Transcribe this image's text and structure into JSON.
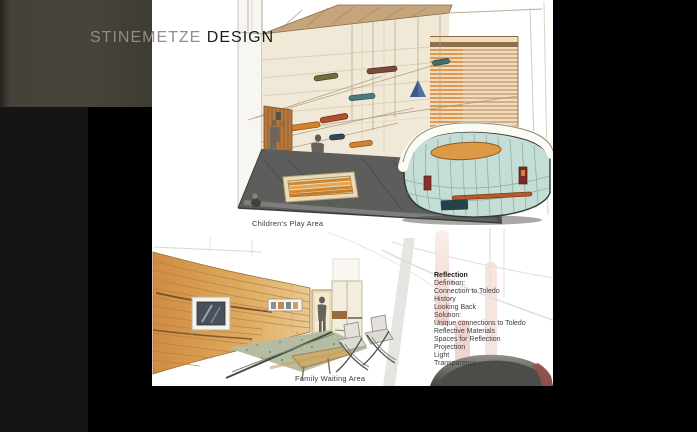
{
  "brand": {
    "muted": "STINEMETZE",
    "strong": "DESIGN"
  },
  "slide": {
    "captions": {
      "children": "Children's Play Area",
      "family": "Family Waiting Area"
    },
    "list": {
      "heading": "Reflection",
      "items": [
        "Definition:",
        "Connection to Toledo",
        "History",
        "Looking Back",
        "Solution:",
        "Unique connections to Toledo",
        "Reflective Materials",
        "Spaces for Reflection",
        "Projection",
        "Light",
        "Transparency"
      ]
    }
  },
  "colors": {
    "letterbox": "#000000",
    "olive_panel": "#46423a",
    "dark_strip": "#151514",
    "slide_bg": "#ffffff",
    "title_muted": "#8f8d86",
    "title_strong": "#1d1d1d",
    "ceiling_tan": "#c6a57b",
    "wall_cream": "#f0e9d7",
    "wood_slat_orange": "#d4813a",
    "floor_charcoal": "#5d5d5b",
    "rug_orange": "#d0862f",
    "desk_teal": "#c4ded5",
    "desk_top_white": "#fbfaf3",
    "desk_disc_orange": "#dd9a44",
    "accent_rust": "#b65a28",
    "accent_navy": "#23424e",
    "wood_wall_gradient": [
      "#d08c42",
      "#eac890"
    ],
    "tv_screen": "#49505a",
    "terrazzo_green": "#b4bda2",
    "ghost_pink": "#efcdc4",
    "bowl_gray": "#4c4c48"
  }
}
